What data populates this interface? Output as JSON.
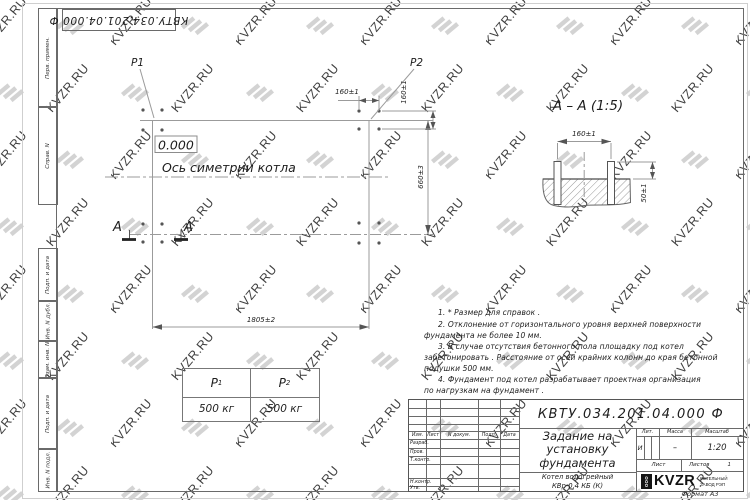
{
  "watermark": {
    "text": "KVZR.RU"
  },
  "sheet": {
    "doc_number": "КВТУ.034.201.04.000  Ф",
    "format_label": "Формат А3",
    "margin_labels": [
      "Перв. примен.",
      "Справ. N",
      "Подп. и дата",
      "Инв. N дубл.",
      "Взам. инв. N",
      "Подп. и дата",
      "Инв. N подл."
    ]
  },
  "plan": {
    "label_p1": "P1",
    "label_p2": "P2",
    "level_mark": "0.000",
    "axis_label": "Ось симетрии котла",
    "dim_width": "1805±2",
    "dim_height": "660±3",
    "dim_bolt_h": "160±1",
    "dim_bolt_v": "160±1",
    "section_letter_left": "A",
    "section_letter_right": "A"
  },
  "section_view": {
    "title": "A – A (1:5)",
    "dim_spacing": "160±1",
    "dim_protrusion": "50±1"
  },
  "load_table": {
    "col1": {
      "symbol": "P",
      "sub": "1",
      "value": "500 кг"
    },
    "col2": {
      "symbol": "P",
      "sub": "2",
      "value": "500 кг"
    }
  },
  "notes": {
    "lines": [
      "1. * Размер для справок .",
      "2. Отклонение от горизонтального уровня верхней поверхности",
      "фундамента не более 10 мм.",
      "3. В случае отсутствия бетонного пола площадку под котел",
      "забетонировать . Расстояние от осей крайних колонн до края бетонной",
      "подушки 500 мм.",
      "4. Фундамент под котел разрабатывает проектная организация",
      "по нагрузкам на фундамент ."
    ]
  },
  "titleblock": {
    "doc_number": "КВТУ.034.201.04.000  Ф",
    "title_line1": "Задание на",
    "title_line2": "установку",
    "title_line3": "фундамента",
    "product_line1": "Котел водогрейный",
    "product_line2": "КВр-0,4  КБ  (К)",
    "header_cols": [
      "Изм.",
      "Лист",
      "N докум.",
      "Подп.",
      "Дата"
    ],
    "row_labels": [
      "Разраб.",
      "Пров.",
      "Т.контр.",
      "Н.контр.",
      "Утв."
    ],
    "lit_header": "Лит.",
    "mass_header": "Масса",
    "scale_header": "Масштаб",
    "lit_value": "И",
    "mass_value": "–",
    "scale_value": "1:20",
    "sheet_label": "Лист",
    "sheets_label": "Листов",
    "sheets_value": "1",
    "logo": {
      "ooo": "ООО",
      "name": "KVZR",
      "sub1": "КОТЕЛЬНЫЙ",
      "sub2": "ЗАВОД РЭП"
    }
  }
}
